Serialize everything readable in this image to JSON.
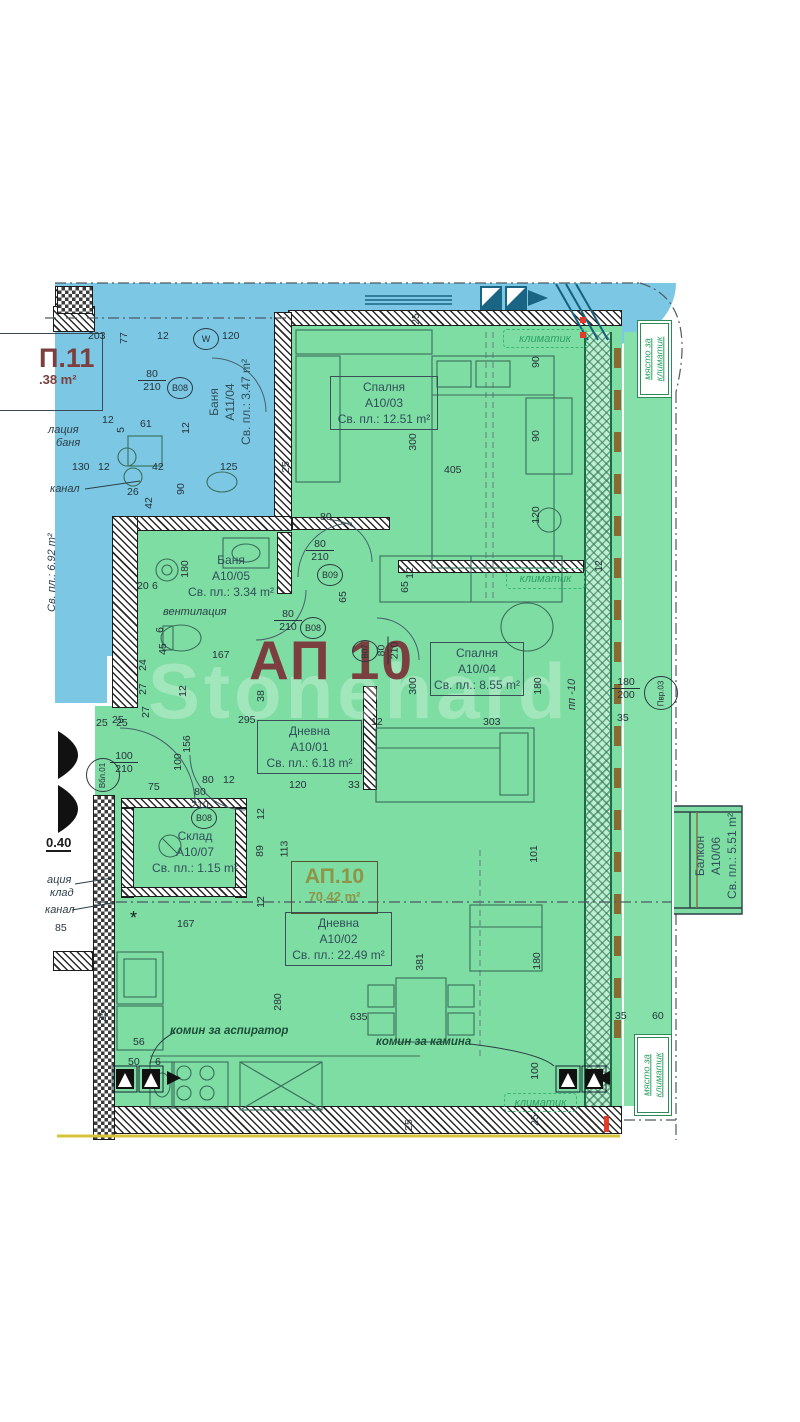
{
  "apartment_title": "АП 10",
  "watermark": "Stonehard",
  "apt11": {
    "title": "П.11",
    "area": ".38 m²"
  },
  "apt10_summary": {
    "title": "АП.10",
    "area": "70.42 m²"
  },
  "colors": {
    "blue_fill": "#7cc7e3",
    "green_fill": "#7edda3",
    "maroon": "#7b3f3f",
    "olive": "#8f9447",
    "green_label": "#2ea164",
    "yellow_line": "#d8c43a",
    "red_mark": "#e23b2e"
  },
  "rooms": [
    {
      "name": "Баня",
      "code": "A11/04",
      "area": "Св. пл.: 3.47 m²",
      "x": 206,
      "y": 458,
      "w": 112,
      "rot": true,
      "boxed": false
    },
    {
      "name": "Спалня",
      "code": "A10/03",
      "area": "Св. пл.: 12.51 m²",
      "x": 330,
      "y": 376,
      "w": 108,
      "rot": false,
      "boxed": true
    },
    {
      "name": "Баня",
      "code": "A10/05",
      "area": "Св. пл.: 3.34 m²",
      "x": 185,
      "y": 552,
      "w": 92,
      "rot": false,
      "boxed": false
    },
    {
      "name": "Спалня",
      "code": "A10/04",
      "area": "Св. пл.: 8.55 m²",
      "x": 430,
      "y": 642,
      "w": 94,
      "rot": false,
      "boxed": true
    },
    {
      "name": "Дневна",
      "code": "A10/01",
      "area": "Св. пл.: 6.18 m²",
      "x": 257,
      "y": 720,
      "w": 105,
      "rot": false,
      "boxed": true
    },
    {
      "name": "Склад",
      "code": "A10/07",
      "area": "Св. пл.: 1.15 m²",
      "x": 148,
      "y": 828,
      "w": 94,
      "rot": false,
      "boxed": false
    },
    {
      "name": "Дневна",
      "code": "A10/02",
      "area": "Св. пл.: 22.49 m²",
      "x": 285,
      "y": 912,
      "w": 107,
      "rot": false,
      "boxed": true
    },
    {
      "name": "Балкон",
      "code": "A10/06",
      "area": "Св. пл.: 5.51 m²",
      "x": 692,
      "y": 902,
      "w": 92,
      "rot": true,
      "boxed": false
    }
  ],
  "green_labels": [
    {
      "text": "климатик",
      "x": 503,
      "y": 329,
      "w": 82,
      "h": 17,
      "vertical": false
    },
    {
      "text": "климатик",
      "x": 506,
      "y": 568,
      "w": 77,
      "h": 19,
      "vertical": false
    },
    {
      "text": "климатик",
      "x": 504,
      "y": 1093,
      "w": 71,
      "h": 17,
      "vertical": false
    },
    {
      "text": "място за климатик",
      "x": 637,
      "y": 320,
      "w": 33,
      "h": 76,
      "vertical": true
    },
    {
      "text": "място за климатик",
      "x": 634,
      "y": 1034,
      "w": 36,
      "h": 80,
      "vertical": true
    }
  ],
  "annotations": [
    {
      "text": "вентилация",
      "x": 163,
      "y": 606,
      "cls": "note"
    },
    {
      "text": "канал",
      "x": 50,
      "y": 483,
      "cls": "note"
    },
    {
      "text": "канал",
      "x": 45,
      "y": 904,
      "cls": "note"
    },
    {
      "text": "лация",
      "x": 48,
      "y": 424,
      "cls": "note"
    },
    {
      "text": "баня",
      "x": 56,
      "y": 437,
      "cls": "note"
    },
    {
      "text": "ация",
      "x": 47,
      "y": 874,
      "cls": "note"
    },
    {
      "text": "клад",
      "x": 50,
      "y": 887,
      "cls": "note"
    },
    {
      "text": "85",
      "x": 55,
      "y": 922,
      "cls": "dim"
    },
    {
      "text": "0.40",
      "x": 46,
      "y": 835,
      "cls": "elev"
    },
    {
      "text": "комин за аспиратор",
      "x": 170,
      "y": 1025,
      "cls": "chimney"
    },
    {
      "text": "комин за камина",
      "x": 376,
      "y": 1036,
      "cls": "chimney"
    },
    {
      "text": "*",
      "x": 130,
      "y": 908,
      "cls": "star"
    },
    {
      "text": "пп -10",
      "x": 566,
      "y": 710,
      "cls": "note",
      "rot": true
    },
    {
      "text": "Св. пл.: 6.92 m²",
      "x": 46,
      "y": 612,
      "cls": "note",
      "rot": true
    }
  ],
  "dims": [
    {
      "t": "203",
      "x": 88,
      "y": 330
    },
    {
      "t": "77",
      "x": 118,
      "y": 332,
      "r": 1
    },
    {
      "t": "12",
      "x": 157,
      "y": 330
    },
    {
      "t": "120",
      "x": 222,
      "y": 330
    },
    {
      "t": "61",
      "x": 140,
      "y": 418
    },
    {
      "t": "12",
      "x": 102,
      "y": 414
    },
    {
      "t": "5",
      "x": 118,
      "y": 424,
      "r": 1
    },
    {
      "t": "12",
      "x": 180,
      "y": 422,
      "r": 1
    },
    {
      "t": "130",
      "x": 72,
      "y": 461
    },
    {
      "t": "12",
      "x": 98,
      "y": 461
    },
    {
      "t": "42",
      "x": 152,
      "y": 461
    },
    {
      "t": "125",
      "x": 220,
      "y": 461
    },
    {
      "t": "25",
      "x": 280,
      "y": 461,
      "r": 1
    },
    {
      "t": "26",
      "x": 127,
      "y": 486
    },
    {
      "t": "42",
      "x": 143,
      "y": 497,
      "r": 1
    },
    {
      "t": "90",
      "x": 175,
      "y": 483,
      "r": 1
    },
    {
      "t": "25",
      "x": 410,
      "y": 313,
      "r": 1
    },
    {
      "t": "300",
      "x": 404,
      "y": 436,
      "r": 1
    },
    {
      "t": "405",
      "x": 444,
      "y": 464
    },
    {
      "t": "90",
      "x": 530,
      "y": 356,
      "r": 1
    },
    {
      "t": "90",
      "x": 530,
      "y": 430,
      "r": 1
    },
    {
      "t": "120",
      "x": 527,
      "y": 509,
      "r": 1
    },
    {
      "t": "80",
      "x": 320,
      "y": 511
    },
    {
      "t": "180",
      "x": 176,
      "y": 563,
      "r": 1
    },
    {
      "t": "20",
      "x": 137,
      "y": 580
    },
    {
      "t": "6",
      "x": 152,
      "y": 580
    },
    {
      "t": "6",
      "x": 157,
      "y": 624,
      "r": 1
    },
    {
      "t": "45",
      "x": 157,
      "y": 643,
      "r": 1
    },
    {
      "t": "167",
      "x": 212,
      "y": 649
    },
    {
      "t": "24",
      "x": 137,
      "y": 659,
      "r": 1
    },
    {
      "t": "27",
      "x": 137,
      "y": 683,
      "r": 1
    },
    {
      "t": "12",
      "x": 177,
      "y": 685,
      "r": 1
    },
    {
      "t": "38",
      "x": 255,
      "y": 690,
      "r": 1
    },
    {
      "t": "295",
      "x": 238,
      "y": 714
    },
    {
      "t": "25",
      "x": 112,
      "y": 714
    },
    {
      "t": "65",
      "x": 337,
      "y": 591,
      "r": 1
    },
    {
      "t": "65",
      "x": 399,
      "y": 581,
      "r": 1
    },
    {
      "t": "12",
      "x": 404,
      "y": 567,
      "r": 1
    },
    {
      "t": "300",
      "x": 404,
      "y": 680,
      "r": 1
    },
    {
      "t": "12",
      "x": 371,
      "y": 716
    },
    {
      "t": "303",
      "x": 483,
      "y": 716
    },
    {
      "t": "180",
      "x": 529,
      "y": 680,
      "r": 1
    },
    {
      "t": "35",
      "x": 617,
      "y": 712
    },
    {
      "t": "25",
      "x": 96,
      "y": 717
    },
    {
      "t": "25",
      "x": 116,
      "y": 717
    },
    {
      "t": "27",
      "x": 140,
      "y": 706,
      "r": 1
    },
    {
      "t": "156",
      "x": 178,
      "y": 738,
      "r": 1
    },
    {
      "t": "100",
      "x": 169,
      "y": 756,
      "r": 1
    },
    {
      "t": "75",
      "x": 148,
      "y": 781
    },
    {
      "t": "80",
      "x": 202,
      "y": 774
    },
    {
      "t": "12",
      "x": 223,
      "y": 774
    },
    {
      "t": "120",
      "x": 289,
      "y": 779
    },
    {
      "t": "33",
      "x": 348,
      "y": 779
    },
    {
      "t": "89",
      "x": 254,
      "y": 845,
      "r": 1
    },
    {
      "t": "113",
      "x": 276,
      "y": 843,
      "r": 1
    },
    {
      "t": "12",
      "x": 255,
      "y": 808,
      "r": 1
    },
    {
      "t": "12",
      "x": 255,
      "y": 896,
      "r": 1
    },
    {
      "t": "381",
      "x": 411,
      "y": 956,
      "r": 1
    },
    {
      "t": "101",
      "x": 525,
      "y": 848,
      "r": 1
    },
    {
      "t": "180",
      "x": 528,
      "y": 955,
      "r": 1
    },
    {
      "t": "280",
      "x": 269,
      "y": 996,
      "r": 1
    },
    {
      "t": "635",
      "x": 350,
      "y": 1011
    },
    {
      "t": "167",
      "x": 177,
      "y": 918
    },
    {
      "t": "56",
      "x": 133,
      "y": 1036
    },
    {
      "t": "50",
      "x": 128,
      "y": 1056
    },
    {
      "t": "6",
      "x": 155,
      "y": 1056
    },
    {
      "t": "25",
      "x": 97,
      "y": 1010,
      "r": 1
    },
    {
      "t": "100",
      "x": 526,
      "y": 1065,
      "r": 1
    },
    {
      "t": "35",
      "x": 615,
      "y": 1010
    },
    {
      "t": "60",
      "x": 652,
      "y": 1010
    },
    {
      "t": "25",
      "x": 529,
      "y": 1114,
      "r": 1
    },
    {
      "t": "25",
      "x": 403,
      "y": 1119,
      "r": 1
    },
    {
      "t": "12",
      "x": 593,
      "y": 560,
      "r": 1
    }
  ],
  "door_tags": [
    {
      "t": "W",
      "x": 193,
      "y": 328
    },
    {
      "t": "B08",
      "x": 167,
      "y": 377
    },
    {
      "t": "B09",
      "x": 317,
      "y": 564
    },
    {
      "t": "B08",
      "x": 300,
      "y": 617
    },
    {
      "t": "B07",
      "x": 352,
      "y": 640,
      "rot": true
    },
    {
      "t": "B08",
      "x": 191,
      "y": 807
    },
    {
      "t": "Вбл.01",
      "x": 86,
      "y": 758,
      "big": true,
      "rot": true
    },
    {
      "t": "Пвр.03",
      "x": 644,
      "y": 676,
      "big": true,
      "rot": true
    }
  ],
  "door_dims": [
    {
      "a": "80",
      "b": "210",
      "x": 138,
      "y": 368
    },
    {
      "a": "80",
      "b": "210",
      "x": 306,
      "y": 538
    },
    {
      "a": "80",
      "b": "210",
      "x": 274,
      "y": 608
    },
    {
      "a": "80",
      "b": "210",
      "x": 374,
      "y": 638,
      "r": 1
    },
    {
      "a": "100",
      "b": "210",
      "x": 110,
      "y": 750
    },
    {
      "a": "80",
      "b": "210",
      "x": 186,
      "y": 786
    },
    {
      "a": "180",
      "b": "200",
      "x": 612,
      "y": 676
    }
  ]
}
